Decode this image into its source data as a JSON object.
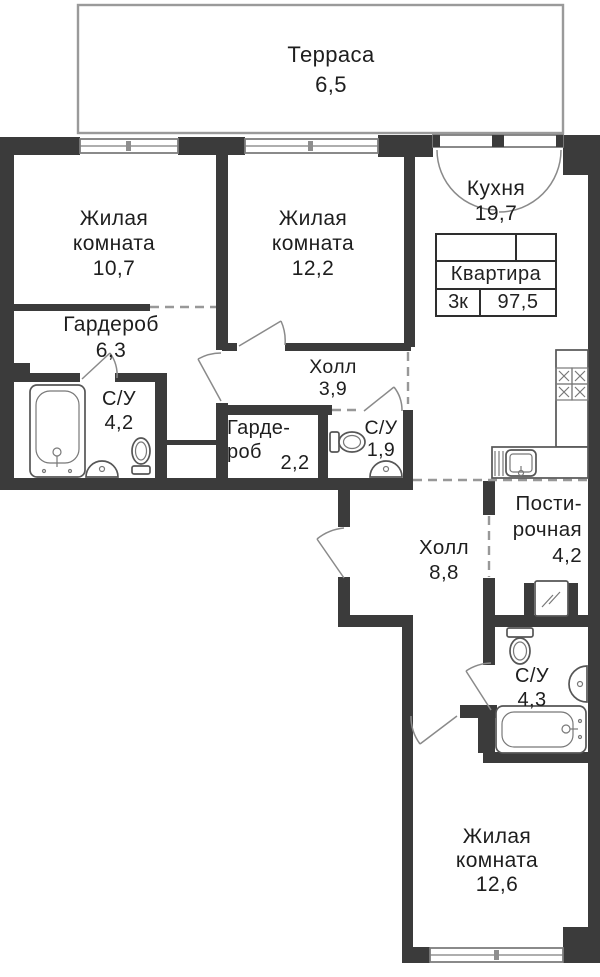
{
  "terrace": {
    "name": "Терраса",
    "area": "6,5"
  },
  "stamp": {
    "title": "Квартира",
    "rooms_count": "3к",
    "total_area": "97,5"
  },
  "rooms": {
    "living1": {
      "lines": [
        "Жилая",
        "комната"
      ],
      "area": "10,7"
    },
    "living2": {
      "lines": [
        "Жилая",
        "комната"
      ],
      "area": "12,2"
    },
    "kitchen": {
      "lines": [
        "Кухня"
      ],
      "area": "19,7"
    },
    "wardrobe1": {
      "lines": [
        "Гардероб"
      ],
      "area": "6,3"
    },
    "bath1": {
      "lines": [
        "С/У"
      ],
      "area": "4,2"
    },
    "hall1": {
      "lines": [
        "Холл"
      ],
      "area": "3,9"
    },
    "wardrobe2": {
      "lines": [
        "Гарде-",
        "роб"
      ],
      "area": "2,2"
    },
    "bath2": {
      "lines": [
        "С/У"
      ],
      "area": "1,9"
    },
    "hall2": {
      "lines": [
        "Холл"
      ],
      "area": "8,8"
    },
    "laundry": {
      "lines": [
        "Пости-",
        "рочная"
      ],
      "area": "4,2"
    },
    "bath3": {
      "lines": [
        "С/У"
      ],
      "area": "4,3"
    },
    "living3": {
      "lines": [
        "Жилая",
        "комната"
      ],
      "area": "12,6"
    }
  },
  "colors": {
    "wall": "#3b3b3b",
    "line": "#8a8a8a",
    "text": "#1e1e1e"
  },
  "icons": [
    "bathtub-icon",
    "sink-icon",
    "toilet-icon",
    "stove-icon",
    "kitchen-sink-icon",
    "washing-machine-icon",
    "window-symbol",
    "door-swing-arc"
  ]
}
